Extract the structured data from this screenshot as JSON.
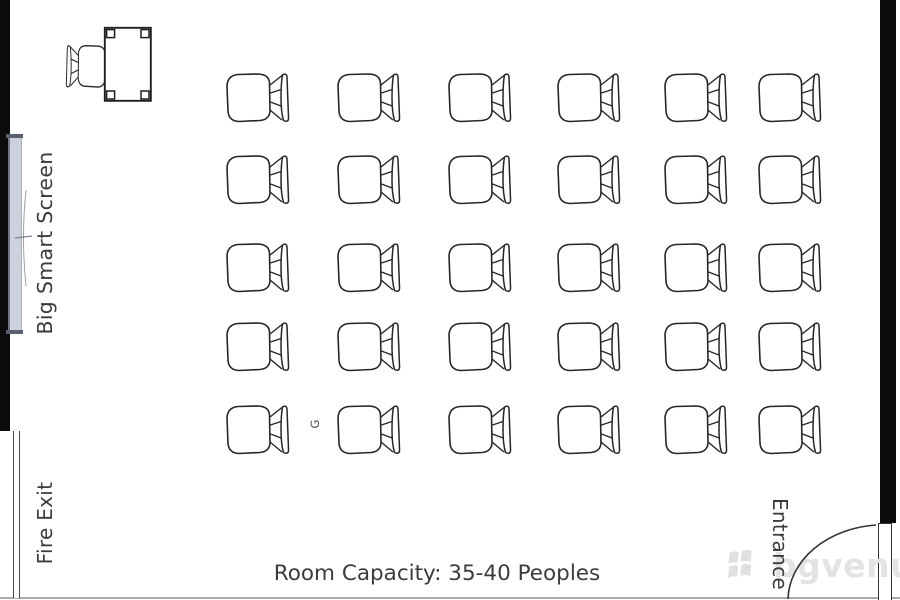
{
  "labels": {
    "screen": "Big Smart Screen",
    "fire_exit": "Fire Exit",
    "entrance": "Entrance",
    "capacity": "Room Capacity: 35-40 Peoples",
    "row_marker": "G"
  },
  "watermark": {
    "text": "bgvenue",
    "icon": "flag-grid-icon"
  },
  "colors": {
    "wall": "#0b0b0b",
    "drawing_outline": "#262626",
    "label_text": "#3b3b3b",
    "screen_fill": "#ccd1dc",
    "watermark_gray": "#e3e3e3"
  },
  "seating": {
    "type": "grid",
    "rows": 5,
    "columns": 6,
    "total_chairs": 30,
    "columns_x": [
      225,
      336,
      447,
      556,
      663,
      757
    ],
    "rows_y": [
      72,
      154,
      242,
      321,
      404
    ],
    "chair_width": 66,
    "chair_height": 52,
    "facing": "left-toward-screen"
  }
}
